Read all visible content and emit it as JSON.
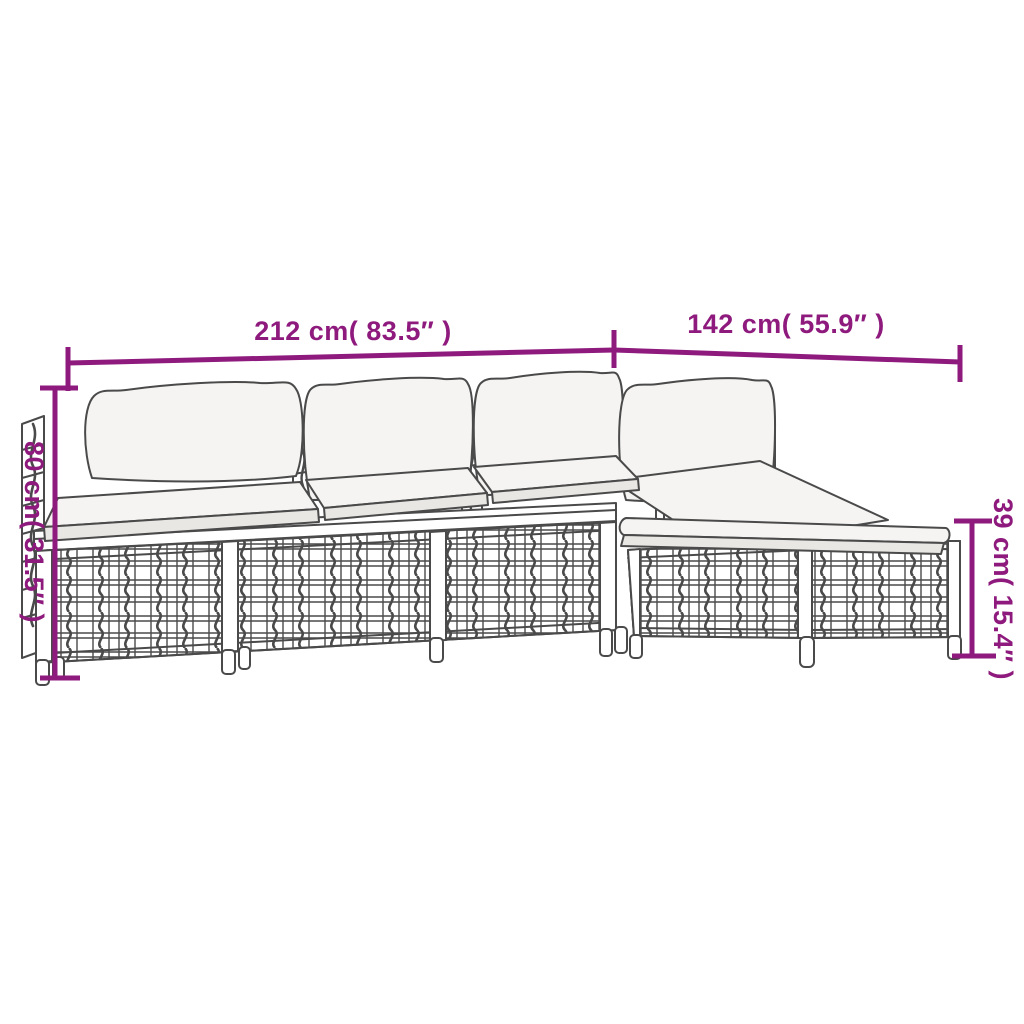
{
  "diagram": {
    "title": "4 Piece Patio Lounge Set with Cushions — dimension diagram",
    "type": "product-dimension-diagram"
  },
  "colors": {
    "accent_magenta": "#8E1A7D",
    "line_gray": "#4A4A4A",
    "cushion_top": "#F5F4F2",
    "cushion_side": "#E9E7E4",
    "background": "#FFFFFF"
  },
  "dimensions": {
    "total_width": {
      "label": "212 cm( 83.5″ )",
      "cm": 212,
      "inches": 83.5
    },
    "depth": {
      "label": "142 cm( 55.9″ )",
      "cm": 142,
      "inches": 55.9
    },
    "height": {
      "label": "80 cm( 31.5″ )",
      "cm": 80,
      "inches": 31.5
    },
    "seat_height": {
      "label": "39 cm( 15.4″ )",
      "cm": 39,
      "inches": 15.4
    }
  },
  "parts": {
    "sofa_modules": "3 armless sofa sections with back cushions",
    "corner_section": "corner section with back cushion",
    "footstool": "footstool with cushion"
  }
}
